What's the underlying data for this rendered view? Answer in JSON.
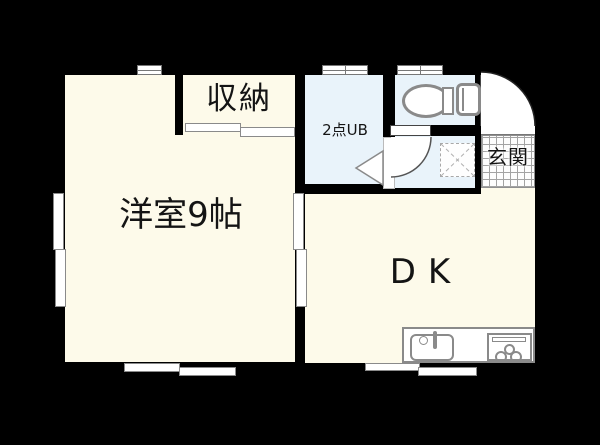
{
  "plan": {
    "type": "japanese-apartment-floor-plan",
    "background": "#000000",
    "colors": {
      "room_floor": "#FDFAEA",
      "wet_area_floor": "#E9F3FA",
      "wall": "#000000",
      "fixture_outline": "#8a8a8a",
      "label_text": "#141414",
      "entrance_tile_line": "#a3a3a3"
    },
    "rooms": {
      "western_room": {
        "label": "洋室9帖"
      },
      "closet": {
        "label": "収納"
      },
      "unit_bath": {
        "label": "2点UB"
      },
      "toilet_room": {
        "label": ""
      },
      "washroom": {
        "label": ""
      },
      "entrance": {
        "label": "玄関"
      },
      "dining_kitchen": {
        "label": "DK"
      }
    },
    "fixtures": [
      "toilet-icon",
      "washing-machine-space-icon",
      "kitchen-sink-icon",
      "gas-stove-icon",
      "entrance-door-swing-icon",
      "washroom-door-swing-icon",
      "unit-bath-door-icon",
      "sliding-door-symbols",
      "window-symbols"
    ]
  }
}
